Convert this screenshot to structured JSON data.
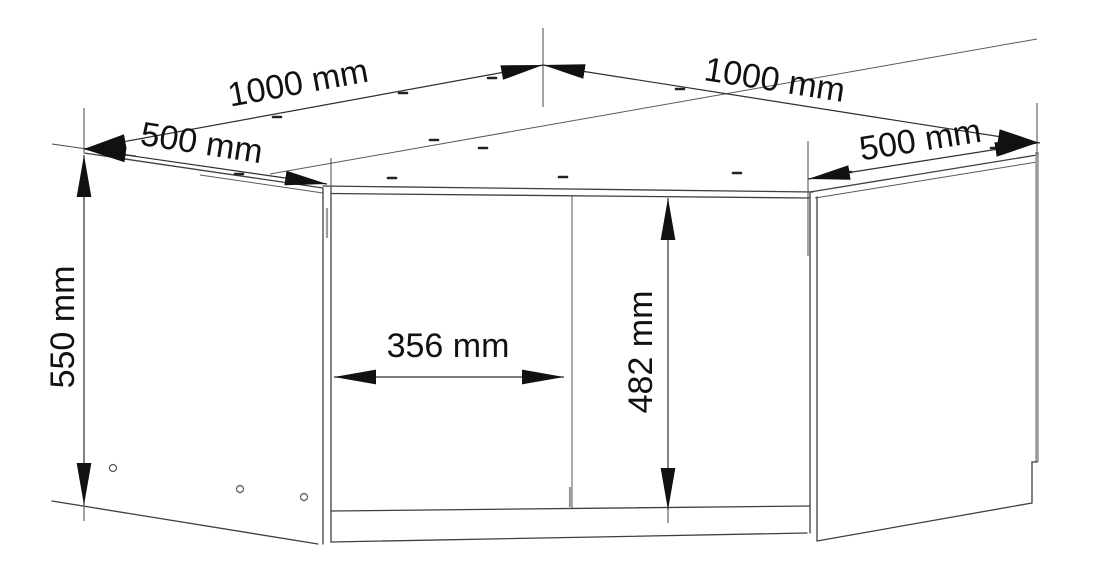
{
  "diagram": {
    "subject": "corner-wall-cabinet-dimension-drawing",
    "unit": "mm",
    "background_color": "#ffffff",
    "line_color": "#3f3f3f",
    "text_color": "#111111",
    "labels": {
      "top_left_width": "1000 mm",
      "top_right_width": "1000 mm",
      "left_side_depth": "500 mm",
      "right_side_depth": "500 mm",
      "cabinet_height": "550 mm",
      "door_width": "356 mm",
      "door_height": "482 mm"
    },
    "values": {
      "top_left_width_mm": 1000,
      "top_right_width_mm": 1000,
      "left_side_depth_mm": 500,
      "right_side_depth_mm": 500,
      "cabinet_height_mm": 550,
      "door_width_mm": 356,
      "door_height_mm": 482
    }
  }
}
